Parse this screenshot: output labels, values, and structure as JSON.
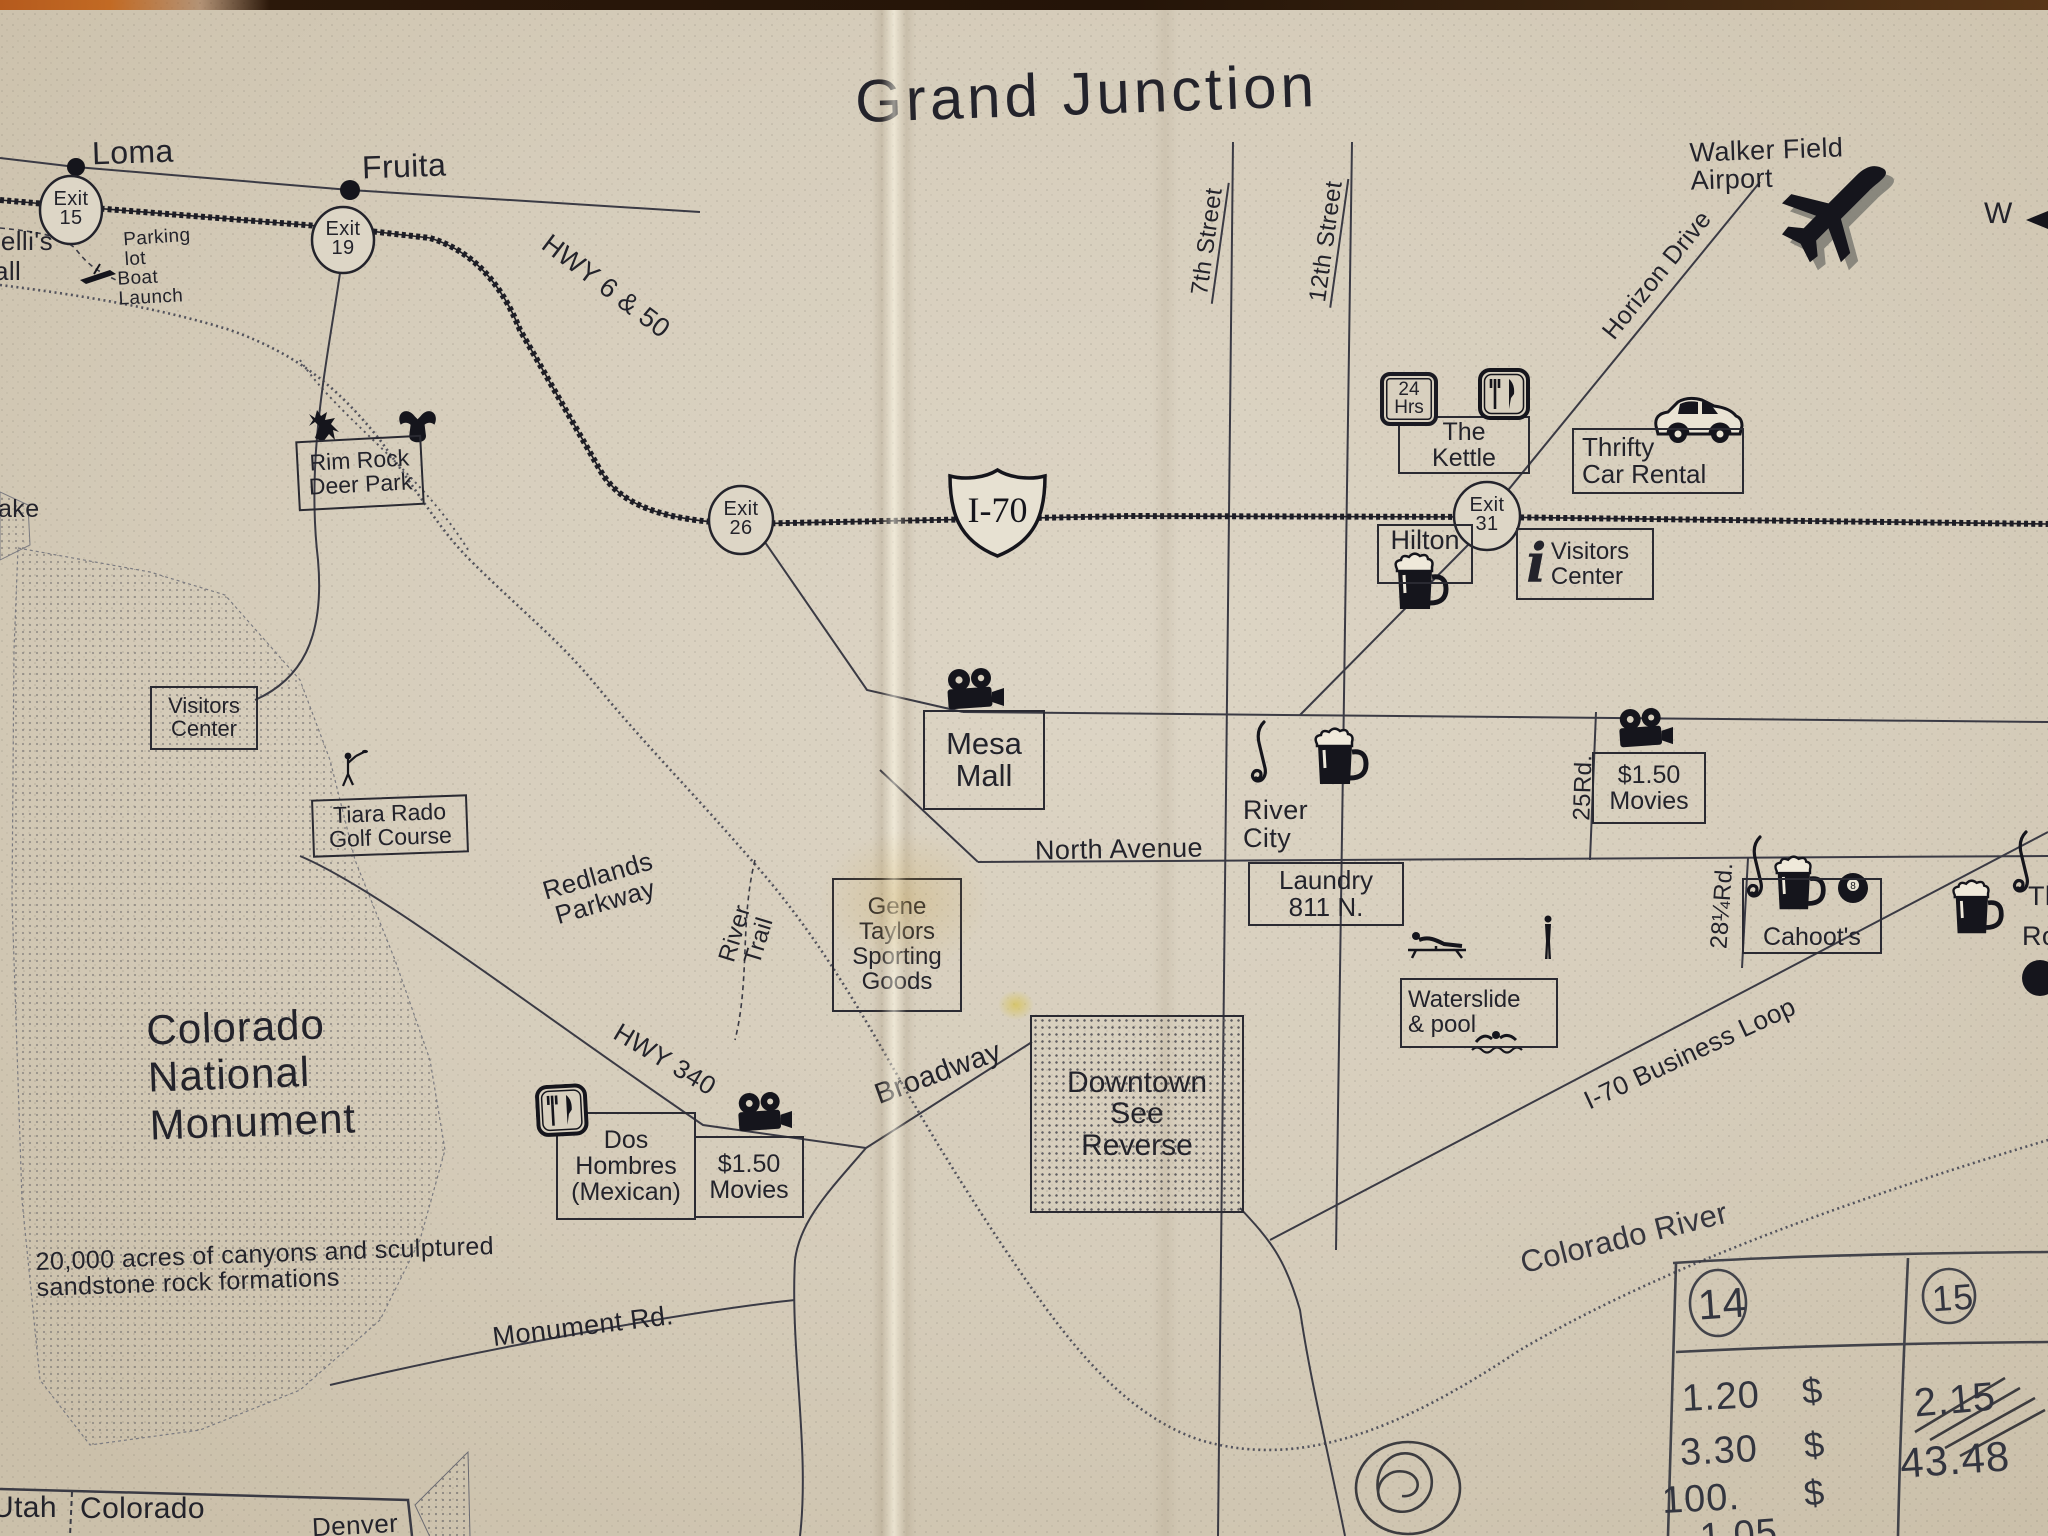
{
  "title": "Grand Junction",
  "compass_w": "W",
  "towns": {
    "loma": "Loma",
    "fruita": "Fruita"
  },
  "exits": {
    "e15": "Exit\n15",
    "e19": "Exit\n19",
    "e26": "Exit\n26",
    "e31": "Exit\n31"
  },
  "shield": {
    "i70": "I-70"
  },
  "roads": {
    "hwy650": "HWY 6 & 50",
    "seventh": "7th Street",
    "twelfth": "12th Street",
    "horizon": "Horizon Drive",
    "north_ave": "North Avenue",
    "broadway": "Broadway",
    "hwy340": "HWY 340",
    "monument_rd": "Monument Rd.",
    "redlands": "Redlands\nParkway",
    "river_trail": "River\nTrail",
    "business_loop": "I-70 Business Loop",
    "rd25": "25Rd.",
    "rd28": "28¼Rd.",
    "colorado_river": "Colorado River"
  },
  "pois": {
    "airport": "Walker Field\nAirport",
    "kettle": "The\nKettle",
    "kettle_badge": "24\nHrs",
    "thrifty": "Thrifty\nCar Rental",
    "hilton": "Hilton",
    "visitors_center_e": "Visitors\nCenter",
    "info_i": "i",
    "rim_rock": "Rim Rock\nDeer Park",
    "mesa_mall": "Mesa\nMall",
    "river_city": "River\nCity",
    "laundry": "Laundry\n811 N.",
    "movies_e": "$1.50\nMovies",
    "movies_w": "$1.50\nMovies",
    "cahoots": "Cahoot's",
    "eight_ball": "8",
    "waterslide": "Waterslide\n& pool",
    "gene_taylors": "Gene\nTaylors\nSporting\nGoods",
    "downtown": "Downtown\nSee\nReverse",
    "dos_hombres": "Dos\nHombres\n(Mexican)",
    "visitors_center_w": "Visitors\nCenter",
    "tiara_rado": "Tiara Rado\nGolf Course",
    "parking_lot": "Parking\nlot",
    "boat_launch": "Boat\nLaunch",
    "cnm_title": "Colorado\nNational\nMonument",
    "cnm_desc": "20,000 acres of canyons and sculptured\nsandstone rock formations"
  },
  "partials": {
    "left_top_1": "belli's",
    "left_top_2": "all",
    "lake": "ake",
    "right_1": "Th",
    "right_2": "Ro"
  },
  "inset": {
    "utah": "Utah",
    "colorado": "Colorado",
    "denver": "Denver"
  },
  "handwriting": {
    "col_a": "14",
    "col_b": "15",
    "a1": "1.20",
    "a2": "3.30",
    "a3": "100.",
    "a4": "1.05",
    "d1": "$",
    "d2": "$",
    "d3": "$",
    "b1": "2.15",
    "b2": "43.48"
  }
}
